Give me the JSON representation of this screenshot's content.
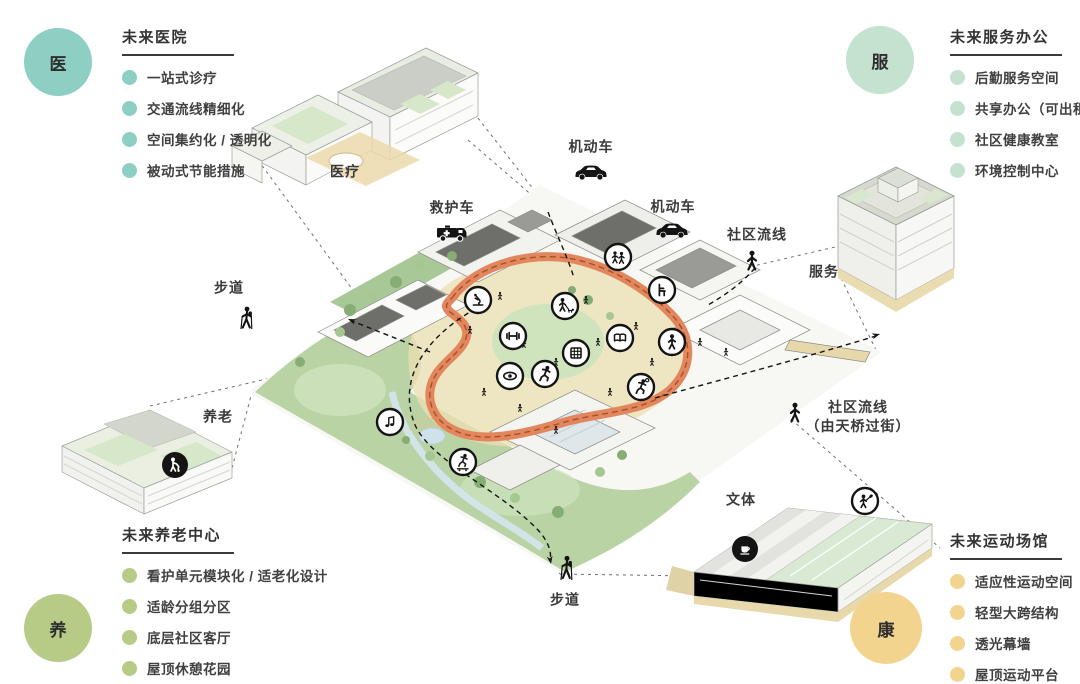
{
  "panels": {
    "hospital": {
      "badge": "医",
      "badge_color": "#8ecfc4",
      "title": "未来医院",
      "items": [
        "一站式诊疗",
        "交通流线精细化",
        "空间集约化 / 透明化",
        "被动式节能措施"
      ]
    },
    "service": {
      "badge": "服",
      "badge_color": "#c5e1cf",
      "title": "未来服务办公",
      "items": [
        "后勤服务空间",
        "共享办公（可出租）",
        "社区健康教室",
        "环境控制中心"
      ]
    },
    "elderly": {
      "badge": "养",
      "badge_color": "#b7cb86",
      "title": "未来养老中心",
      "items": [
        "看护单元模块化 / 适老化设计",
        "适龄分组分区",
        "底层社区客厅",
        "屋顶休憩花园"
      ]
    },
    "sports": {
      "badge": "康",
      "badge_color": "#f2d48e",
      "title": "未来运动场馆",
      "items": [
        "适应性运动空间",
        "轻型大跨结构",
        "透光幕墙",
        "屋顶运动平台"
      ]
    }
  },
  "map": {
    "labels": {
      "medical": "医疗",
      "motor_top": "机动车",
      "ambulance": "救护车",
      "motor_right": "机动车",
      "community_flow_top": "社区流线",
      "service": "服务",
      "footpath_left": "步道",
      "elderly": "养老",
      "community_flow_bridge_1": "社区流线",
      "community_flow_bridge_2": "（由天桥过街）",
      "culture_sports": "文体",
      "footpath_bottom": "步道"
    },
    "icons": [
      "car-icon",
      "ambulance-icon",
      "pedestrian-icon",
      "hiker-icon",
      "microscope-icon",
      "gym-dumbbell-icon",
      "dog-walking-icon",
      "eye-icon",
      "runner-icon",
      "window-grid-icon",
      "book-icon",
      "chair-icon",
      "person-icon",
      "basketball-player-icon",
      "people-icon",
      "music-icon",
      "skateboard-icon",
      "table-tennis-player-icon",
      "coffee-icon",
      "stroller-icon"
    ]
  },
  "colors": {
    "teal": "#8ecfc4",
    "mint": "#c5e1cf",
    "olive": "#b7cb86",
    "sand": "#f2d48e",
    "loop_orange": "#e2875d",
    "loop_dash": "#a84f2a",
    "site_green": "#b9d3a4",
    "path_beige": "#ecdfb4",
    "water": "#cfe2ea",
    "ink": "#333333"
  }
}
